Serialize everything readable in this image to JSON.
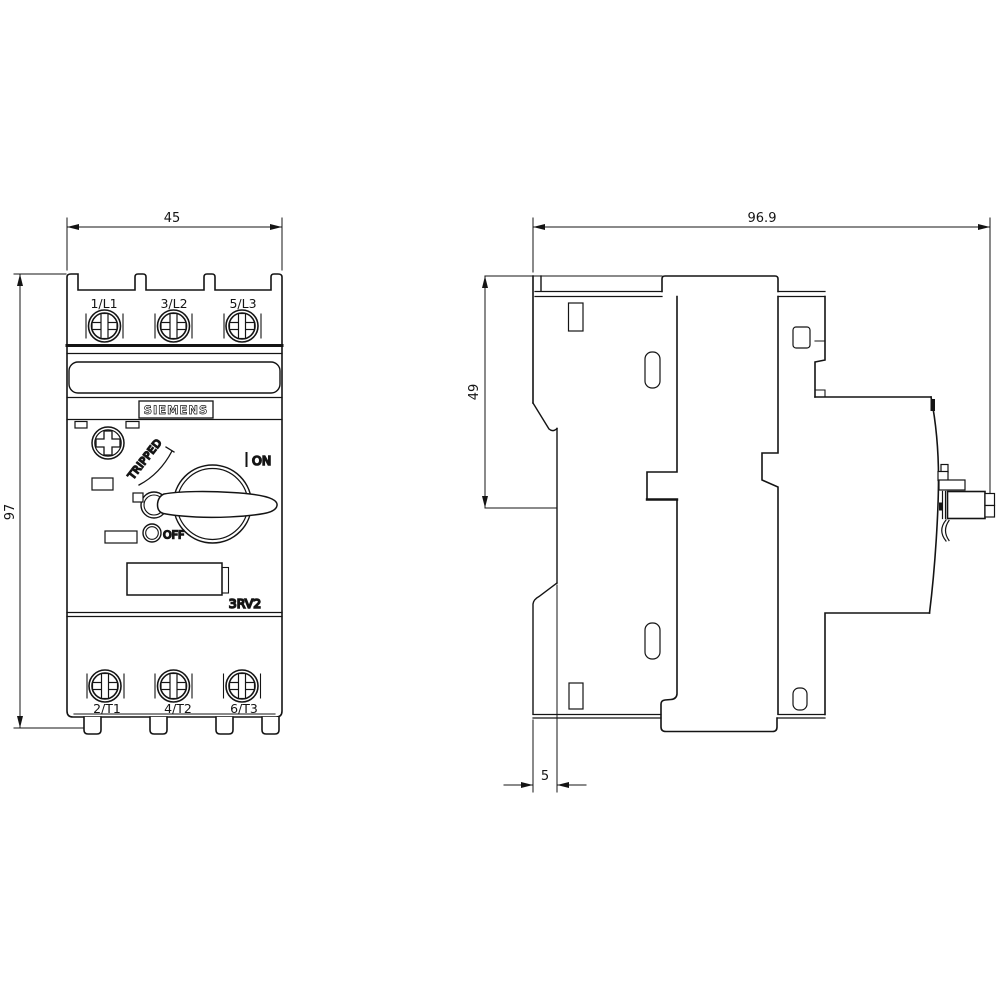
{
  "title": "Siemens 3RV2 motor starter protector dimensional drawing",
  "brand": "SIEMENS",
  "model": "3RV2",
  "front": {
    "top_terminals": [
      "1/L1",
      "3/L2",
      "5/L3"
    ],
    "bottom_terminals": [
      "2/T1",
      "4/T2",
      "6/T3"
    ],
    "labels": {
      "tripped": "TRIPPED",
      "on": "ON",
      "off": "OFF"
    }
  },
  "dimensions": {
    "width": "45",
    "height": "97",
    "depth": "96.9",
    "upper_depth": "49",
    "rail_offset": "5"
  },
  "colors": {
    "line": "#141414",
    "bg": "#ffffff"
  }
}
